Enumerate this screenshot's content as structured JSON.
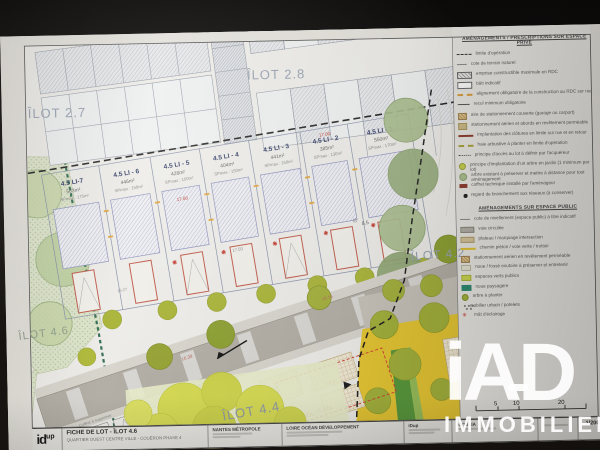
{
  "watermark": {
    "brand": "iAD",
    "tagline": "IMMOBILIER"
  },
  "plan": {
    "ilots": [
      {
        "label": "ÎLOT 2.7"
      },
      {
        "label": "ÎLOT 2.8"
      },
      {
        "label": "ÎLOT 4.2"
      },
      {
        "label": "ÎLOT 4.4"
      },
      {
        "label": "ÎLOT 4.6"
      }
    ],
    "plots": [
      {
        "name": "4.5 LI-7",
        "area": "583m²",
        "sp": "SPmax : 175m²"
      },
      {
        "name": "4.5 LI - 6",
        "area": "446m²",
        "sp": "SPmax : 150m²"
      },
      {
        "name": "4.5 LI - 5",
        "area": "428m²",
        "sp": "SPmax : 150m²"
      },
      {
        "name": "4.5 LI - 4",
        "area": "404m²",
        "sp": "SPmax : 150m²"
      },
      {
        "name": "4.5 LI - 3",
        "area": "441m²",
        "sp": "SPmax : 150m²"
      },
      {
        "name": "4.5 LI - 2",
        "area": "385m²",
        "sp": "SPmax : 130m²"
      },
      {
        "name": "4.5 LI - 1",
        "area": "550m²",
        "sp": "SPmax : 170m²"
      }
    ],
    "dims": {
      "a": "17.00",
      "b": "17.00",
      "c": "17.50",
      "d": "8.5",
      "e": "12",
      "f": "16.27",
      "g": "16.39",
      "h": "18.16"
    },
    "notes": {
      "coffret": "Coffret à supprimer",
      "places": "+ 6 pl.",
      "sol": "SOL / S.SOL"
    }
  },
  "legend": {
    "private": {
      "title": "AMÉNAGEMENTS / PRESCRIPTIONS SUR ESPACE PRIVÉ",
      "items": [
        {
          "icon": "boundary-dashed",
          "label": "limite d'opération"
        },
        {
          "icon": "ngf-level",
          "label": "cote de terrain naturel"
        },
        {
          "icon": "hatched-rect",
          "label": "emprise constructible maximale en RDC"
        },
        {
          "icon": "outline-rect",
          "label": "bâti indicatif"
        },
        {
          "icon": "orange-dash",
          "label": "alignement obligatoire de la construction au RDC sur rue"
        },
        {
          "icon": "recul-arrow",
          "label": "recul minimum obligatoire"
        },
        {
          "icon": "tan-hatch-square",
          "label": "aire de stationnement couverte (garage ou carport)"
        },
        {
          "icon": "khaki-square",
          "label": "stationnement aérien et abords en revêtement perméable"
        },
        {
          "icon": "darkred-line",
          "label": "implantation des clôtures en limite sur rue et en retour"
        },
        {
          "icon": "olive-dash",
          "label": "haie arbustive à planter en limite d'opération"
        },
        {
          "icon": "access-line",
          "label": "principe d'accès au lot à définir par l'acquéreur"
        },
        {
          "icon": "yellowgreen-circle",
          "label": "principe d'implantation d'un arbre en jardin (1 minimum par lot)"
        },
        {
          "icon": "sage-circle",
          "label": "arbre existant à préserver et mettre à distance pour tout aménagement"
        },
        {
          "icon": "darkred-rect",
          "label": "coffret technique installé par l'aménageur"
        },
        {
          "icon": "black-dot",
          "label": "regard de branchement aux réseaux (à conserver)"
        }
      ]
    },
    "public": {
      "title": "AMÉNAGEMENTS SUR ESPACE PUBLIC",
      "items": [
        {
          "icon": "ngf-level",
          "label": "cote de nivellement (espace public) à titre indicatif"
        },
        {
          "icon": "road-swatch",
          "label": "voie circulée"
        },
        {
          "icon": "tan-square",
          "label": "plateau / marquage intersection"
        },
        {
          "icon": "yellow-line",
          "label": "chemin piéton / voie verte / trottoir"
        },
        {
          "icon": "tan-hatch-square",
          "label": "stationnement aérien en revêtement perméable"
        },
        {
          "icon": "pale-square",
          "label": "noue / fossé exutoire à préserver et entretenir"
        },
        {
          "icon": "yellowgreen-square",
          "label": "espaces verts publics"
        },
        {
          "icon": "teal-square",
          "label": "noue paysagère"
        },
        {
          "icon": "olive-circle",
          "label": "arbre à planter"
        },
        {
          "icon": "dot-cluster",
          "label": "mobilier urbain / potelets"
        },
        {
          "icon": "red-asterisk",
          "label": "mât d'éclairage"
        }
      ]
    }
  },
  "scalebar": {
    "t5": "5",
    "t10": "10",
    "t20": "20"
  },
  "titleblock": {
    "logo_main": "id",
    "logo_sup": "up",
    "title": "FICHE DE LOT - ÎLOT 4.6",
    "subtitle": "QUARTIER OUEST CENTRE VILLE - COUËRON PHASE 4",
    "client": "NANTES MÉTROPOLE",
    "developer": "LOIRE OCÉAN DÉVELOPPEMENT",
    "author": "iDup",
    "engineer": "ARTELIA",
    "scale": "1/200"
  }
}
